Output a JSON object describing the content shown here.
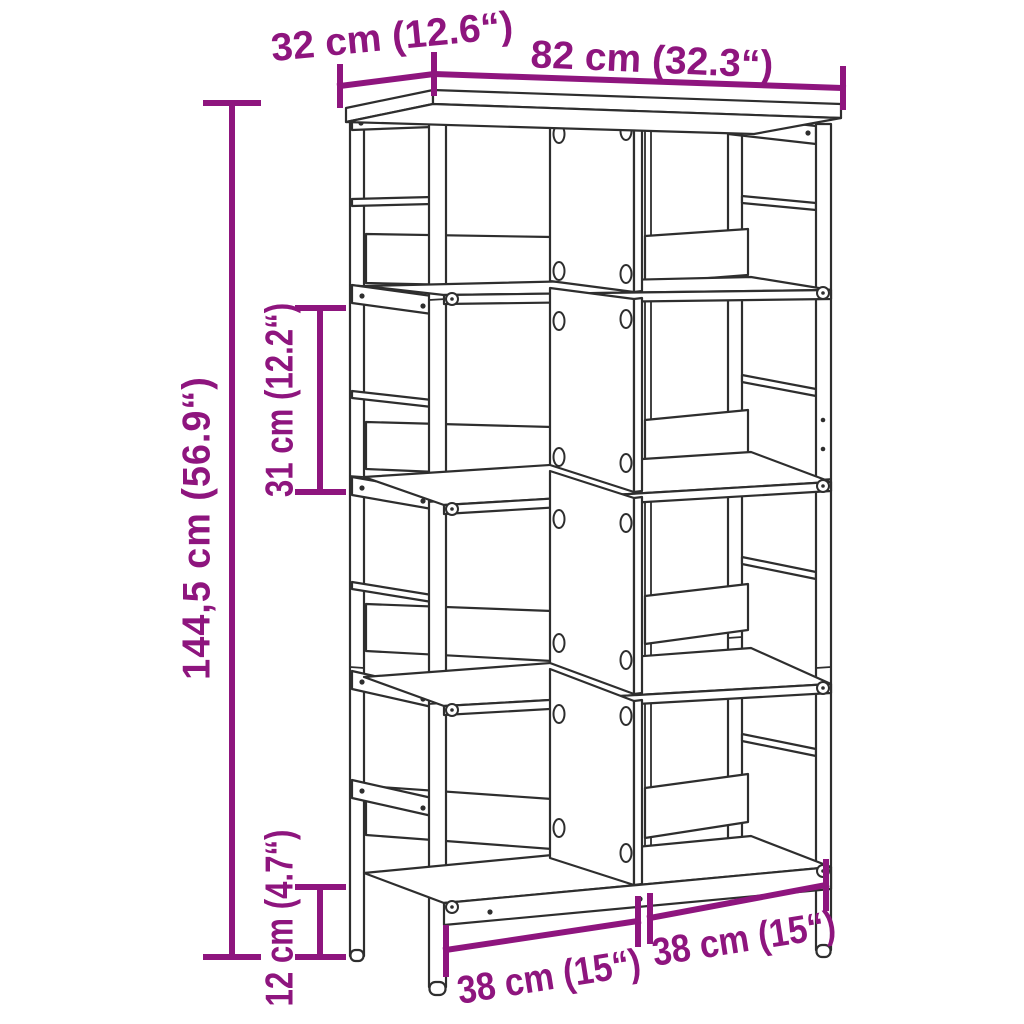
{
  "diagram": {
    "kind": "furniture dimension line drawing",
    "labels": {
      "depth": "32 cm (12.6“)",
      "width": "82 cm (32.3“)",
      "height": "144,5 cm (56.9“)",
      "shelf_spacing": "31 cm (12.2“)",
      "ground_clearance": "12 cm (4.7“)",
      "compartment_left": "38 cm (15“)",
      "compartment_right": "38 cm (15“)"
    },
    "colors": {
      "dimension": "#8E157E",
      "line_art": "#2E2E2E",
      "background": "#FFFFFF"
    }
  }
}
